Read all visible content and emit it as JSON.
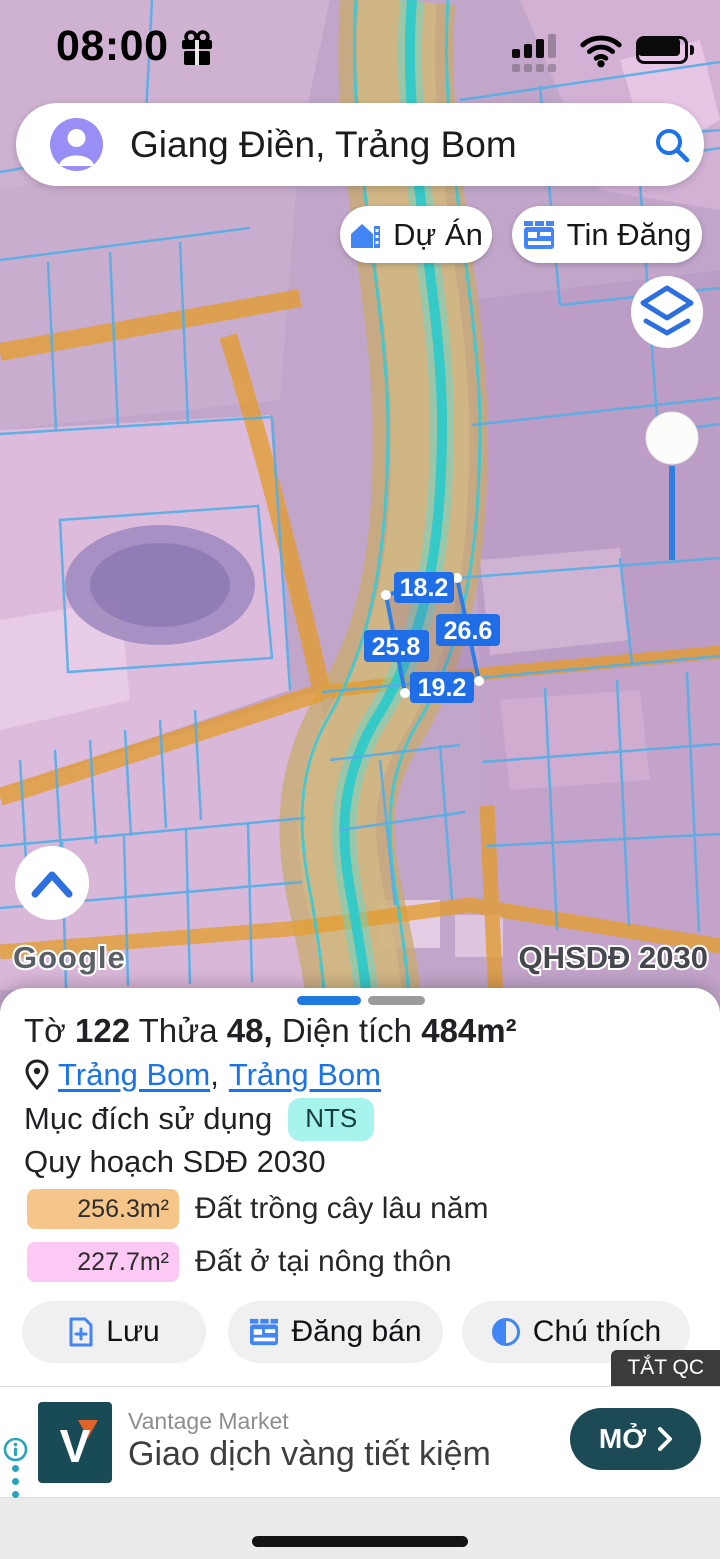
{
  "status_bar": {
    "time": "08:00"
  },
  "search": {
    "query": "Giang Điền, Trảng Bom"
  },
  "map_overlay": {
    "project_button": "Dự Án",
    "listing_button": "Tin Đăng",
    "watermark": "Google",
    "plan_code": "QHSDĐ 2030",
    "measurements": [
      "18.2",
      "26.6",
      "25.8",
      "19.2"
    ],
    "dimension_label_color": "#1f6ee8"
  },
  "sheet": {
    "title": {
      "sheet_label": "Tờ",
      "sheet_no": "122",
      "parcel_label": "Thửa",
      "parcel_no": "48,",
      "area_label": "Diện tích",
      "area_value": "484m²"
    },
    "location": {
      "link1": "Trảng Bom",
      "separator": ",",
      "link2": "Trảng Bom"
    },
    "usage": {
      "label": "Mục đích sử dụng",
      "badge": "NTS",
      "badge_color": "#a7f4ef"
    },
    "plan_row": "Quy hoạch SDĐ 2030",
    "legend": [
      {
        "area": "256.3m²",
        "label": "Đất trồng cây lâu năm",
        "color": "#f6c58a"
      },
      {
        "area": "227.7m²",
        "label": "Đất ở tại nông thôn",
        "color": "#fbc9f3"
      }
    ],
    "actions": {
      "save": "Lưu",
      "sell": "Đăng bán",
      "legend_btn": "Chú thích"
    }
  },
  "ad": {
    "dismiss": "TẮT QC",
    "brand": "Vantage Market",
    "headline": "Giao dịch vàng tiết kiệm",
    "cta": "MỞ",
    "logo_letter": "V",
    "accent_color": "#1c4b55"
  }
}
